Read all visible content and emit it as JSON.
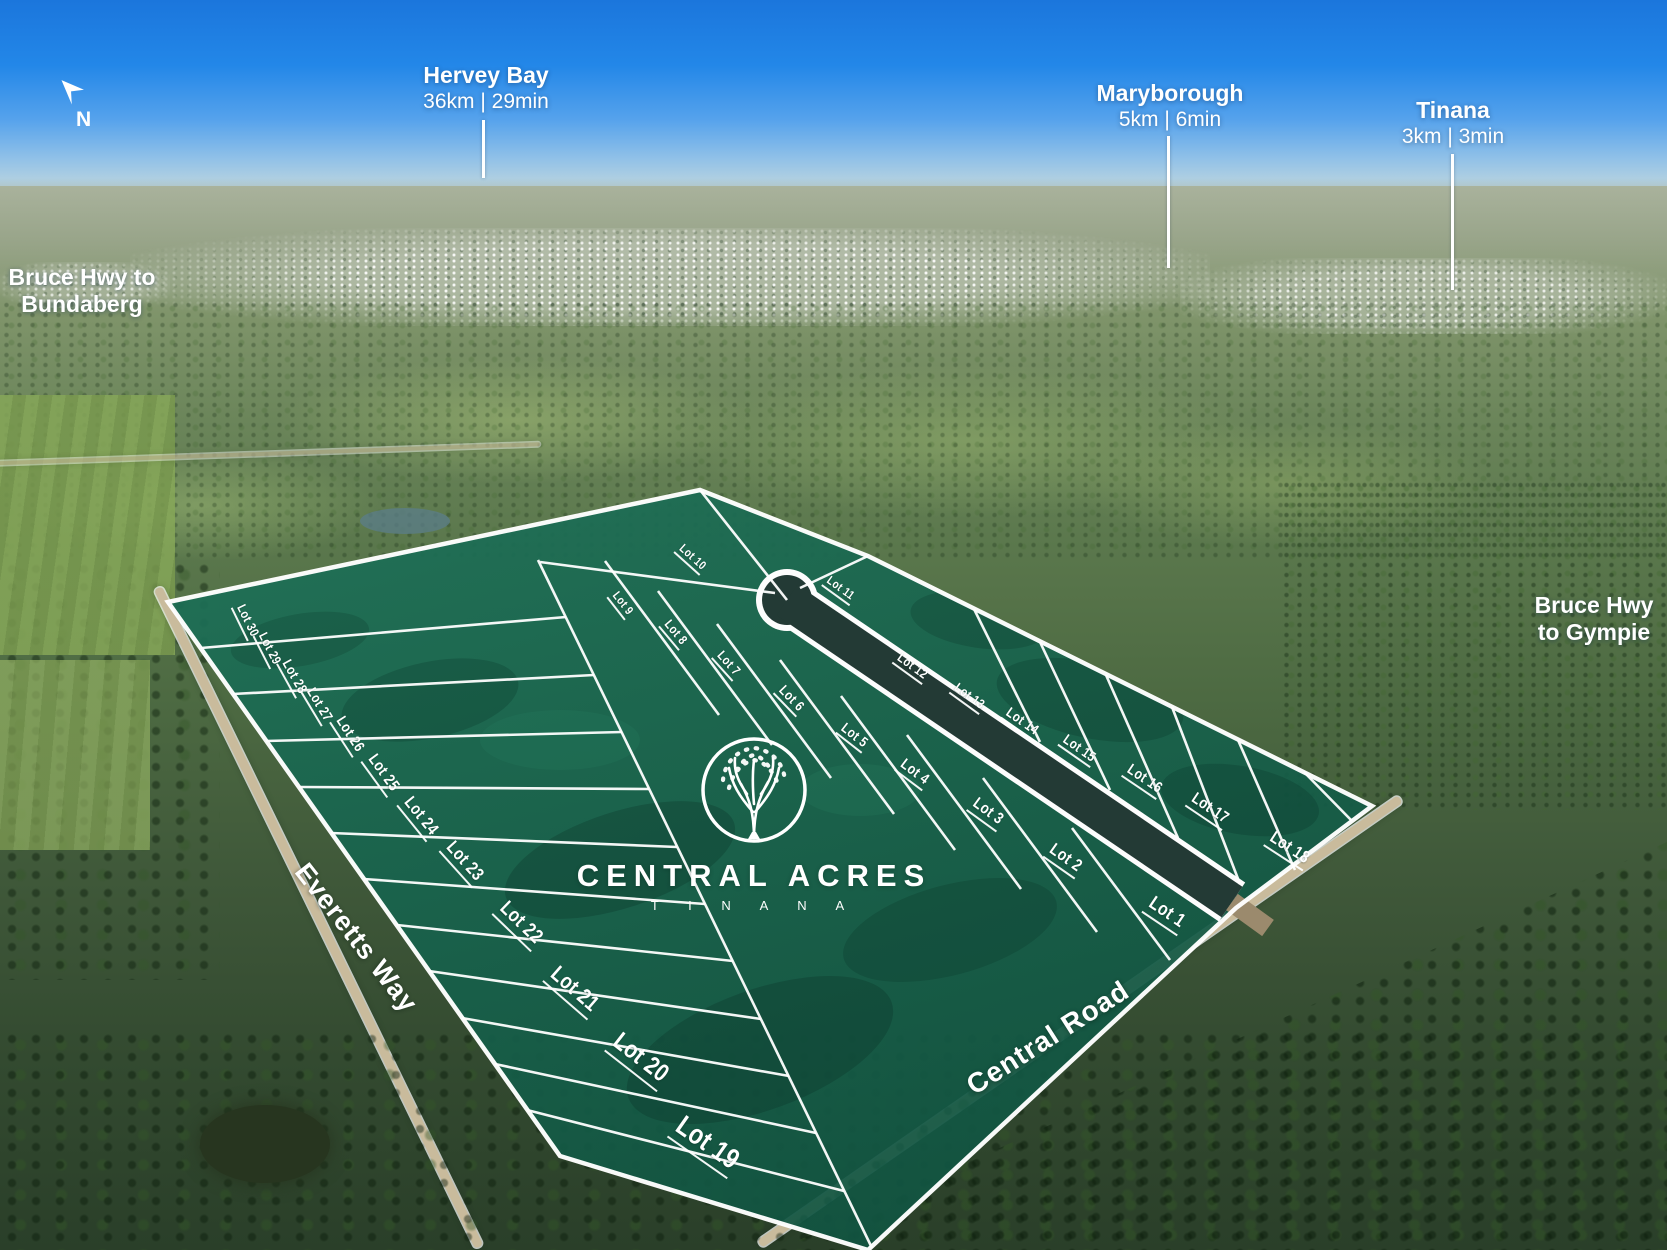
{
  "title": "Central Acres Tinana estate aerial lot map",
  "compass": {
    "label": "N"
  },
  "logo": {
    "name": "CENTRAL ACRES",
    "sub": "T I N A N A"
  },
  "colors": {
    "overlay_green": "#156A51",
    "lot_line": "#FFFFFF",
    "internal_road": "#233A35",
    "label_text": "#FFFFFF",
    "sky_top": "#1B76DC"
  },
  "callouts": [
    {
      "id": "hervey-bay",
      "title": "Hervey Bay",
      "subtitle": "36km | 29min",
      "style": "distance",
      "x": 486,
      "y": 62,
      "line": {
        "x": 482,
        "y1": 120,
        "y2": 178
      }
    },
    {
      "id": "maryborough",
      "title": "Maryborough",
      "subtitle": "5km | 6min",
      "style": "distance",
      "x": 1170,
      "y": 80,
      "line": {
        "x": 1167,
        "y1": 136,
        "y2": 268
      }
    },
    {
      "id": "tinana",
      "title": "Tinana",
      "subtitle": "3km | 3min",
      "style": "distance",
      "x": 1453,
      "y": 97,
      "line": {
        "x": 1451,
        "y1": 154,
        "y2": 290
      }
    },
    {
      "id": "bruce-hwy-bundaberg",
      "title": "Bruce Hwy to",
      "subtitle": "Bundaberg",
      "style": "dir",
      "x": 82,
      "y": 264,
      "line": null
    },
    {
      "id": "bruce-hwy-gympie",
      "title": "Bruce Hwy",
      "subtitle": "to Gympie",
      "style": "dir",
      "x": 1594,
      "y": 592,
      "line": null
    }
  ],
  "road_labels": [
    {
      "id": "everetts-way",
      "label": "Everetts Way",
      "x": 356,
      "y": 938,
      "rot": 52,
      "size": 27
    },
    {
      "id": "central-road",
      "label": "Central Road",
      "x": 1048,
      "y": 1038,
      "rot": -32.5,
      "size": 28
    }
  ],
  "lots": [
    {
      "label": "Lot 30",
      "x": 247,
      "y": 621,
      "rot": 64,
      "size": 13
    },
    {
      "label": "Lot 29",
      "x": 269,
      "y": 649,
      "rot": 63,
      "size": 13
    },
    {
      "label": "Lot 28",
      "x": 294,
      "y": 677,
      "rot": 61,
      "size": 14
    },
    {
      "label": "Lot 27",
      "x": 319,
      "y": 705,
      "rot": 59,
      "size": 14
    },
    {
      "label": "Lot 26",
      "x": 349,
      "y": 735,
      "rot": 57,
      "size": 15
    },
    {
      "label": "Lot 25",
      "x": 382,
      "y": 774,
      "rot": 54,
      "size": 16
    },
    {
      "label": "Lot 24",
      "x": 420,
      "y": 817,
      "rot": 51,
      "size": 17
    },
    {
      "label": "Lot 23",
      "x": 464,
      "y": 862,
      "rot": 48,
      "size": 18
    },
    {
      "label": "Lot 22",
      "x": 520,
      "y": 924,
      "rot": 44,
      "size": 20
    },
    {
      "label": "Lot 21",
      "x": 574,
      "y": 990,
      "rot": 41,
      "size": 22
    },
    {
      "label": "Lot 20",
      "x": 640,
      "y": 1059,
      "rot": 38,
      "size": 25
    },
    {
      "label": "Lot 19",
      "x": 707,
      "y": 1144,
      "rot": 35,
      "size": 28
    },
    {
      "label": "Lot 10",
      "x": 692,
      "y": 558,
      "rot": 42,
      "size": 12
    },
    {
      "label": "Lot 11",
      "x": 840,
      "y": 589,
      "rot": 36,
      "size": 12
    },
    {
      "label": "Lot 9",
      "x": 622,
      "y": 604,
      "rot": 52,
      "size": 12
    },
    {
      "label": "Lot 8",
      "x": 675,
      "y": 633,
      "rot": 50,
      "size": 13
    },
    {
      "label": "Lot 7",
      "x": 728,
      "y": 664,
      "rot": 48,
      "size": 13
    },
    {
      "label": "Lot 6",
      "x": 791,
      "y": 699,
      "rot": 46,
      "size": 14
    },
    {
      "label": "Lot 5",
      "x": 854,
      "y": 736,
      "rot": 38,
      "size": 14
    },
    {
      "label": "Lot 4",
      "x": 914,
      "y": 773,
      "rot": 37,
      "size": 15
    },
    {
      "label": "Lot 3",
      "x": 987,
      "y": 813,
      "rot": 36,
      "size": 16
    },
    {
      "label": "Lot 2",
      "x": 1065,
      "y": 859,
      "rot": 35,
      "size": 17
    },
    {
      "label": "Lot 1",
      "x": 1166,
      "y": 914,
      "rot": 34,
      "size": 19
    },
    {
      "label": "Lot 12",
      "x": 912,
      "y": 667,
      "rot": 36,
      "size": 13
    },
    {
      "label": "Lot 13",
      "x": 969,
      "y": 697,
      "rot": 36,
      "size": 13
    },
    {
      "label": "Lot 14",
      "x": 1022,
      "y": 722,
      "rot": 35,
      "size": 14
    },
    {
      "label": "Lot 15",
      "x": 1079,
      "y": 749,
      "rot": 35,
      "size": 14
    },
    {
      "label": "Lot 16",
      "x": 1144,
      "y": 780,
      "rot": 34,
      "size": 15
    },
    {
      "label": "Lot 17",
      "x": 1209,
      "y": 810,
      "rot": 34,
      "size": 16
    },
    {
      "label": "Lot 18",
      "x": 1289,
      "y": 849,
      "rot": 33,
      "size": 17
    }
  ]
}
